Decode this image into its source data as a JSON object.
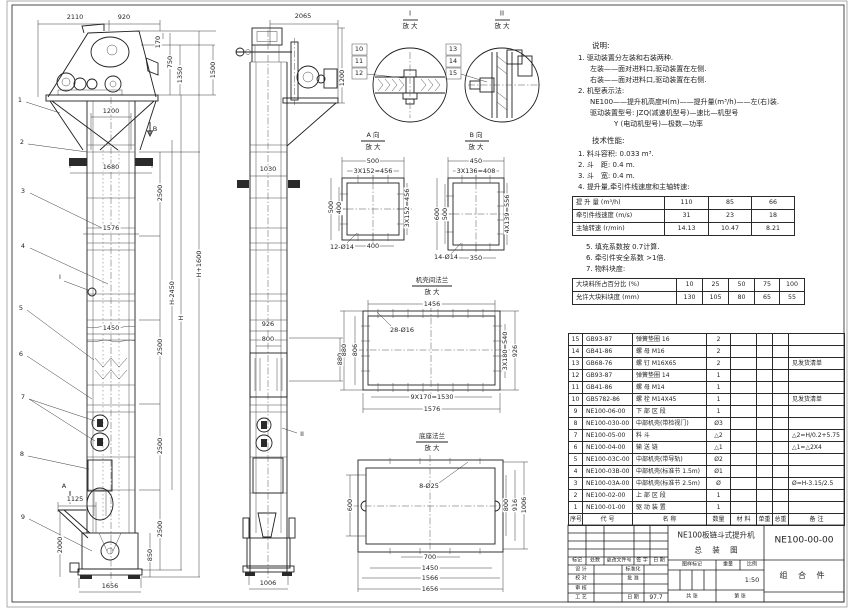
{
  "colors": {
    "paper": "#ffffff",
    "line": "#1f1f1f"
  },
  "front": {
    "callouts": [
      "1",
      "2",
      "3",
      "4",
      "5",
      "6",
      "7",
      "8",
      "9"
    ],
    "marks": {
      "a": "A",
      "b": "B",
      "i": "I"
    },
    "dims": {
      "top_w": "2110",
      "top_w2": "920",
      "head_h1": "170",
      "head_h2": "750",
      "head_h3": "1350",
      "head_h4": "1500",
      "col_top_w": "1200",
      "bracket_w": "1680",
      "sec": "2500",
      "flange_w": "1576",
      "mid_w": "1450",
      "h_minus": "H-2450",
      "h": "H",
      "h_plus": "H+1600",
      "inlet_w": "1125",
      "inlet_h": "2000",
      "boot_h": "850",
      "boot_w": "1656"
    }
  },
  "side": {
    "mark": "II",
    "dims": {
      "top_w": "2065",
      "head_h": "1200",
      "col_w": "1030",
      "insp_w": "926",
      "insp_w2": "800",
      "insp_h": "880",
      "boot_w": "1006"
    }
  },
  "details": {
    "i": {
      "label": "I",
      "zoom": "放 大",
      "callouts": [
        "10",
        "11",
        "12"
      ]
    },
    "ii": {
      "label": "II",
      "zoom": "放 大",
      "callouts": [
        "13",
        "14",
        "15"
      ]
    },
    "a": {
      "label": "A 向",
      "zoom": "放 大",
      "top": "500",
      "top2": "3X152=456",
      "left": "500",
      "left2": "400",
      "right": "3X152=456",
      "bottom": "400",
      "holes": "12-Ø14"
    },
    "b": {
      "label": "B 向",
      "zoom": "放 大",
      "top": "450",
      "top2": "3X136=408",
      "left": "600",
      "left2": "500",
      "right": "4X139=556",
      "bottom": "350",
      "holes": "14-Ø14"
    },
    "cf": {
      "label": "机壳间法兰",
      "zoom": "放 大",
      "top": "1456",
      "left": "880",
      "left2": "806",
      "right": "3X180=540",
      "right2": "926",
      "bottom": "9X170=1530",
      "bottom2": "1576",
      "holes": "28-Ø16"
    },
    "bf": {
      "label": "底座法兰",
      "zoom": "放 大",
      "holes": "8-Ø25",
      "left": "600",
      "right": "800",
      "right2": "916",
      "right3": "1006",
      "bottom": "700",
      "bottom2": "1450",
      "bottom3": "1566",
      "bottom4": "1656"
    }
  },
  "notes": {
    "title": "说明:",
    "lines": [
      "1. 驱动装置分左装和右装两种.",
      "左装——面对进料口,驱动装置在左侧.",
      "右装——面对进料口,驱动装置在右侧.",
      "2. 机型表示法:",
      "NE100——提升机高度H(m)——提升量(m³/h)——左(右)装.",
      "驱动装置型号: JZQ(减速机型号)—速比—机型号",
      "Y (电动机型号)—极数—功率"
    ]
  },
  "tech": {
    "title": "技术性能:",
    "lines": [
      "1. 料斗容积: 0.033 m³.",
      "2. 斗　距: 0.4 m.",
      "3. 斗　宽: 0.4 m.",
      "4. 提升量,牵引件线速度和主轴转速:"
    ],
    "table1": {
      "rows": [
        {
          "label": "提 升 量 (m³/h)",
          "v1": "110",
          "v2": "85",
          "v3": "66"
        },
        {
          "label": "牵引件线速度 (m/s)",
          "v1": "31",
          "v2": "23",
          "v3": "18"
        },
        {
          "label": "主轴转速 (r/min)",
          "v1": "14.13",
          "v2": "10.47",
          "v3": "8.21"
        }
      ]
    },
    "notes2": [
      "5. 填充系数按 0.7计算.",
      "6. 牵引件安全系数 >1倍.",
      "7. 物料块度:"
    ],
    "table2": {
      "rows": [
        {
          "label": "大块料所占百分比 (%)",
          "v1": "10",
          "v2": "25",
          "v3": "50",
          "v4": "75",
          "v5": "100"
        },
        {
          "label": "允许大块料块度 (mm)",
          "v1": "130",
          "v2": "105",
          "v3": "80",
          "v4": "65",
          "v5": "55"
        }
      ]
    }
  },
  "bom": {
    "headers": {
      "no": "序号",
      "code": "代  号",
      "name": "名    称",
      "qty": "数量",
      "mat": "材 料",
      "uw": "单重",
      "tw": "总重",
      "remark": "备  注"
    },
    "rows": [
      {
        "no": "15",
        "code": "GB93-87",
        "name": "弹簧垫圈 16",
        "qty": "2",
        "mat": "",
        "uw": "",
        "tw": "",
        "remark": ""
      },
      {
        "no": "14",
        "code": "GB41-86",
        "name": "螺 母 M16",
        "qty": "2",
        "mat": "",
        "uw": "",
        "tw": "",
        "remark": ""
      },
      {
        "no": "13",
        "code": "GB68-76",
        "name": "螺 钉 M16X65",
        "qty": "2",
        "mat": "",
        "uw": "",
        "tw": "",
        "remark": "见发货清单"
      },
      {
        "no": "12",
        "code": "GB93-87",
        "name": "弹簧垫圈 14",
        "qty": "1",
        "mat": "",
        "uw": "",
        "tw": "",
        "remark": ""
      },
      {
        "no": "11",
        "code": "GB41-86",
        "name": "螺 母 M14",
        "qty": "1",
        "mat": "",
        "uw": "",
        "tw": "",
        "remark": ""
      },
      {
        "no": "10",
        "code": "GB5782-86",
        "name": "螺 栓 M14X45",
        "qty": "1",
        "mat": "",
        "uw": "",
        "tw": "",
        "remark": "见发货清单"
      },
      {
        "no": "9",
        "code": "NE100-06-00",
        "name": "下 部 区 段",
        "qty": "1",
        "mat": "",
        "uw": "",
        "tw": "",
        "remark": ""
      },
      {
        "no": "8",
        "code": "NE100-030-00",
        "name": "中部机壳(带检视门)",
        "qty": "Ø3",
        "mat": "",
        "uw": "",
        "tw": "",
        "remark": ""
      },
      {
        "no": "7",
        "code": "NE100-05-00",
        "name": "料 斗",
        "qty": "△2",
        "mat": "",
        "uw": "",
        "tw": "",
        "remark": "△2=H/0.2+5.75"
      },
      {
        "no": "6",
        "code": "NE100-04-00",
        "name": "输 送 链",
        "qty": "△1",
        "mat": "",
        "uw": "",
        "tw": "",
        "remark": "△1=△2X4"
      },
      {
        "no": "5",
        "code": "NE100-03C-00",
        "name": "中部机壳(带导轨)",
        "qty": "Ø2",
        "mat": "",
        "uw": "",
        "tw": "",
        "remark": ""
      },
      {
        "no": "4",
        "code": "NE100-03B-00",
        "name": "中部机壳(标准节 1.5m)",
        "qty": "Ø1",
        "mat": "",
        "uw": "",
        "tw": "",
        "remark": ""
      },
      {
        "no": "3",
        "code": "NE100-03A-00",
        "name": "中部机壳(标准节 2.5m)",
        "qty": "Ø",
        "mat": "",
        "uw": "",
        "tw": "",
        "remark": "Ø=H-3.15/2.5"
      },
      {
        "no": "2",
        "code": "NE100-02-00",
        "name": "上 部 区 段",
        "qty": "1",
        "mat": "",
        "uw": "",
        "tw": "",
        "remark": ""
      },
      {
        "no": "1",
        "code": "NE100-01-00",
        "name": "驱 动 装 置",
        "qty": "1",
        "mat": "",
        "uw": "",
        "tw": "",
        "remark": ""
      }
    ]
  },
  "titleblock": {
    "product": "NE100板链斗式提升机",
    "sheet_name": "总 装 图",
    "number": "NE100-00-00",
    "kind": "组 合 件",
    "rev": [
      "标记",
      "处数",
      "更改文件号",
      "签 字",
      "日 期"
    ],
    "roles": [
      "设 计",
      "校 对",
      "审 核",
      "工 艺"
    ],
    "roles2": [
      "标准化",
      "批 准",
      "",
      "日 期"
    ],
    "date": "97.7",
    "stamp": "图样标记",
    "weight": "重量",
    "scale": "比例",
    "scale_val": "1:50",
    "sheet_total": "共  张",
    "sheet_no": "第  张"
  }
}
